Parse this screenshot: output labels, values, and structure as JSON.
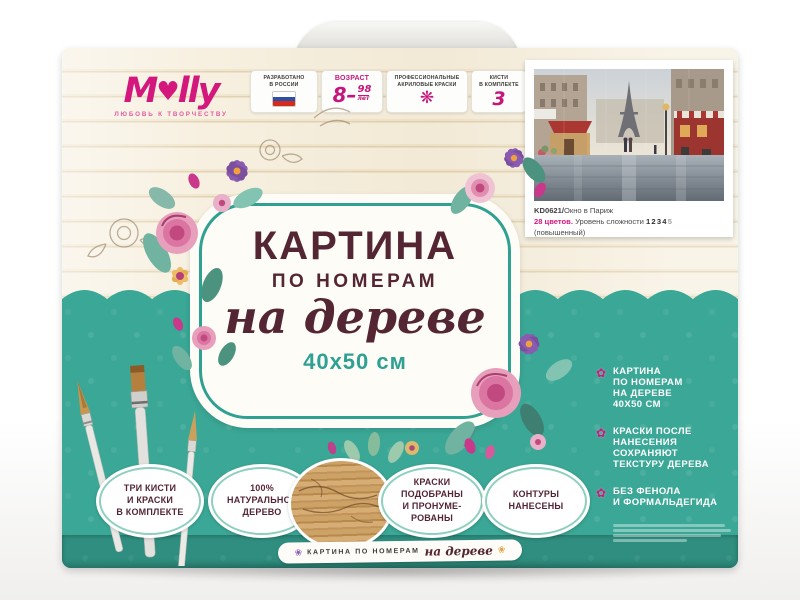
{
  "colors": {
    "brand_pink": "#d4177d",
    "teal": "#3ba796",
    "teal_dark": "#2f8e7f",
    "maroon_text": "#542634",
    "wood": "#f5eedd"
  },
  "brand": {
    "logo_pre": "M",
    "logo_heart": "♥",
    "logo_post": "lly",
    "tagline": "ЛЮБОВЬ К ТВОРЧЕСТВУ"
  },
  "badges": [
    {
      "lines": [
        "РАЗРАБОТАНО",
        "В РОССИИ"
      ],
      "icon": "russia-flag"
    },
    {
      "lines": [
        "ВОЗРАСТ"
      ],
      "value_big": "8–",
      "value_top": "98",
      "value_unit": "лет"
    },
    {
      "lines": [
        "ПРОФЕССИОНАЛЬНЫЕ",
        "АКРИЛОВЫЕ КРАСКИ"
      ],
      "icon": "paint-splat",
      "icon_glyph": "❋"
    },
    {
      "lines": [
        "КИСТИ",
        "В КОМПЛЕКТЕ"
      ],
      "value": "3"
    },
    {
      "lines": [
        "ДЕРЕВЯННАЯ",
        "ОСНОВА"
      ],
      "value": "40×50"
    }
  ],
  "card": {
    "code": "KD0621/",
    "name": "Окно в Париж",
    "colors_count": "28 цветов.",
    "difficulty_label": " Уровень сложности ",
    "difficulty_filled": "1234",
    "difficulty_empty": "5",
    "difficulty_note": " (повышенный)"
  },
  "label": {
    "line1": "КАРТИНА",
    "line2": "ПО НОМЕРАМ",
    "line3": "на дереве",
    "size": "40х50 см"
  },
  "ovals": [
    {
      "lines": [
        "ТРИ КИСТИ",
        "И КРАСКИ",
        "В КОМПЛЕКТЕ"
      ]
    },
    {
      "lines": [
        "100%",
        "НАТУРАЛЬНОЕ",
        "ДЕРЕВО"
      ]
    },
    {
      "lines": [
        "КРАСКИ",
        "ПОДОБРАНЫ",
        "И ПРОНУМЕ-",
        "РОВАНЫ"
      ]
    },
    {
      "lines": [
        "КОНТУРЫ",
        "НАНЕСЕНЫ"
      ]
    }
  ],
  "bullets": [
    {
      "lines": [
        "КАРТИНА",
        "ПО НОМЕРАМ",
        "НА ДЕРЕВЕ",
        "40Х50 СМ"
      ]
    },
    {
      "lines": [
        "КРАСКИ ПОСЛЕ",
        "НАНЕСЕНИЯ",
        "СОХРАНЯЮТ",
        "ТЕКСТУРУ ДЕРЕВА"
      ]
    },
    {
      "lines": [
        "БЕЗ ФЕНОЛА",
        "И ФОРМАЛЬДЕГИДА"
      ]
    }
  ],
  "ribbon": {
    "caps": "КАРТИНА ПО НОМЕРАМ",
    "script": "на дереве"
  },
  "icons": {
    "flower_bullet": "✿",
    "ribbon_flower": "❀"
  }
}
